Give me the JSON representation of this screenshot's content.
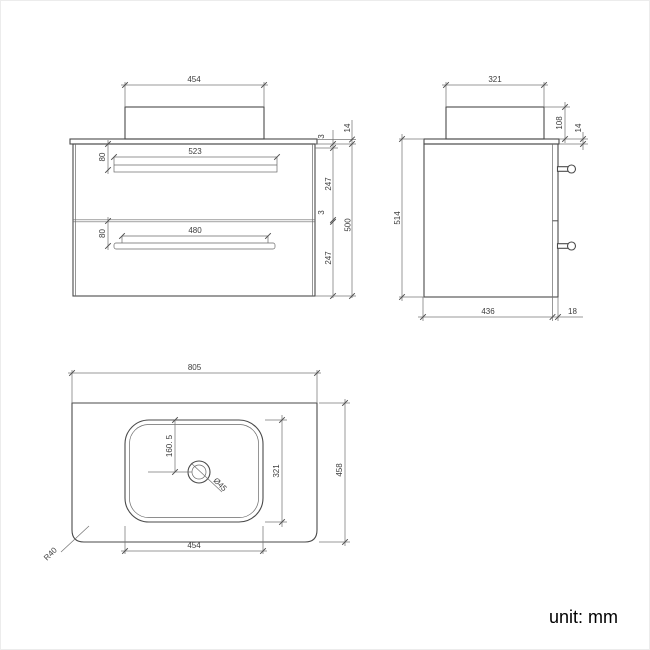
{
  "unit": {
    "label": "unit: mm"
  },
  "front": {
    "basin_width": "454",
    "handle1_width": "523",
    "handle1_offset": "80",
    "gap_top": "3",
    "counter_thickness": "14",
    "drawer1_height": "247",
    "handle2_width": "480",
    "handle2_offset": "80",
    "gap_mid": "3",
    "drawer2_height": "247",
    "cabinet_height": "500"
  },
  "side": {
    "basin_depth": "321",
    "basin_height": "108",
    "counter_thickness": "14",
    "total_height": "514",
    "cabinet_depth": "436",
    "front_panel_thickness": "18"
  },
  "plan": {
    "counter_width": "805",
    "counter_depth": "458",
    "basin_width": "454",
    "basin_depth": "321",
    "drain_offset": "160. 5",
    "drain_diameter": "Ø45",
    "corner_radius": "R40"
  }
}
